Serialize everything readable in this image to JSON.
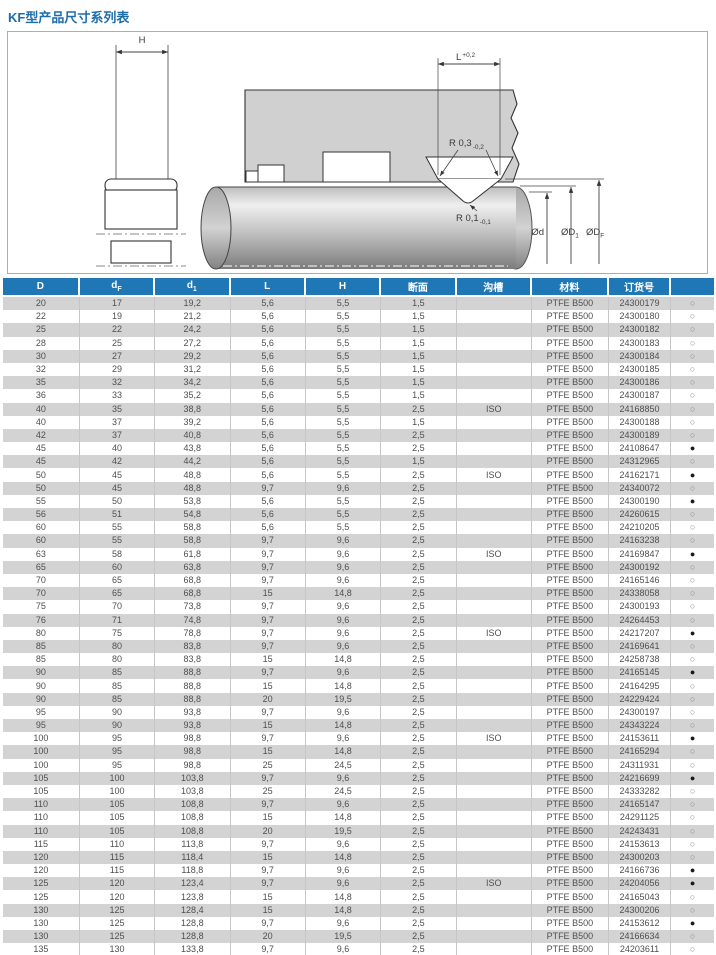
{
  "title": "KF型产品尺寸系列表",
  "diagram": {
    "labels": {
      "h": "H",
      "l": "L",
      "l_tol": "+0,2",
      "r_top": "R 0,3",
      "r_top_tol": "-0,2",
      "r_bottom": "R 0,1",
      "r_bottom_tol": "-0,1",
      "dia_d": "Ød",
      "dia_d1": "ØD",
      "dia_d1_sub": "1",
      "dia_df": "ØD",
      "dia_df_sub": "F"
    }
  },
  "table": {
    "headers": {
      "col_d": "D",
      "col_df": "d",
      "col_df_sub": "F",
      "col_d1": "d",
      "col_d1_sub": "1",
      "col_l": "L",
      "col_h": "H",
      "col_section": "断面",
      "col_groove": "沟槽",
      "col_material": "材料",
      "col_order": "订货号"
    },
    "rows": [
      [
        "20",
        "17",
        "19,2",
        "5,6",
        "5,5",
        "1,5",
        "",
        "PTFE B500",
        "24300179",
        "○"
      ],
      [
        "22",
        "19",
        "21,2",
        "5,6",
        "5,5",
        "1,5",
        "",
        "PTFE B500",
        "24300180",
        "○"
      ],
      [
        "25",
        "22",
        "24,2",
        "5,6",
        "5,5",
        "1,5",
        "",
        "PTFE B500",
        "24300182",
        "○"
      ],
      [
        "28",
        "25",
        "27,2",
        "5,6",
        "5,5",
        "1,5",
        "",
        "PTFE B500",
        "24300183",
        "○"
      ],
      [
        "30",
        "27",
        "29,2",
        "5,6",
        "5,5",
        "1,5",
        "",
        "PTFE B500",
        "24300184",
        "○"
      ],
      [
        "32",
        "29",
        "31,2",
        "5,6",
        "5,5",
        "1,5",
        "",
        "PTFE B500",
        "24300185",
        "○"
      ],
      [
        "35",
        "32",
        "34,2",
        "5,6",
        "5,5",
        "1,5",
        "",
        "PTFE B500",
        "24300186",
        "○"
      ],
      [
        "36",
        "33",
        "35,2",
        "5,6",
        "5,5",
        "1,5",
        "",
        "PTFE B500",
        "24300187",
        "○"
      ],
      [
        "40",
        "35",
        "38,8",
        "5,6",
        "5,5",
        "2,5",
        "ISO",
        "PTFE B500",
        "24168850",
        "○"
      ],
      [
        "40",
        "37",
        "39,2",
        "5,6",
        "5,5",
        "1,5",
        "",
        "PTFE B500",
        "24300188",
        "○"
      ],
      [
        "42",
        "37",
        "40,8",
        "5,6",
        "5,5",
        "2,5",
        "",
        "PTFE B500",
        "24300189",
        "○"
      ],
      [
        "45",
        "40",
        "43,8",
        "5,6",
        "5,5",
        "2,5",
        "",
        "PTFE B500",
        "24108647",
        "●"
      ],
      [
        "45",
        "42",
        "44,2",
        "5,6",
        "5,5",
        "1,5",
        "",
        "PTFE B500",
        "24312965",
        "○"
      ],
      [
        "50",
        "45",
        "48,8",
        "5,6",
        "5,5",
        "2,5",
        "ISO",
        "PTFE B500",
        "24162171",
        "●"
      ],
      [
        "50",
        "45",
        "48,8",
        "9,7",
        "9,6",
        "2,5",
        "",
        "PTFE B500",
        "24340072",
        "○"
      ],
      [
        "55",
        "50",
        "53,8",
        "5,6",
        "5,5",
        "2,5",
        "",
        "PTFE B500",
        "24300190",
        "●"
      ],
      [
        "56",
        "51",
        "54,8",
        "5,6",
        "5,5",
        "2,5",
        "",
        "PTFE B500",
        "24260615",
        "○"
      ],
      [
        "60",
        "55",
        "58,8",
        "5,6",
        "5,5",
        "2,5",
        "",
        "PTFE B500",
        "24210205",
        "○"
      ],
      [
        "60",
        "55",
        "58,8",
        "9,7",
        "9,6",
        "2,5",
        "",
        "PTFE B500",
        "24163238",
        "○"
      ],
      [
        "63",
        "58",
        "61,8",
        "9,7",
        "9,6",
        "2,5",
        "ISO",
        "PTFE B500",
        "24169847",
        "●"
      ],
      [
        "65",
        "60",
        "63,8",
        "9,7",
        "9,6",
        "2,5",
        "",
        "PTFE B500",
        "24300192",
        "○"
      ],
      [
        "70",
        "65",
        "68,8",
        "9,7",
        "9,6",
        "2,5",
        "",
        "PTFE B500",
        "24165146",
        "○"
      ],
      [
        "70",
        "65",
        "68,8",
        "15",
        "14,8",
        "2,5",
        "",
        "PTFE B500",
        "24338058",
        "○"
      ],
      [
        "75",
        "70",
        "73,8",
        "9,7",
        "9,6",
        "2,5",
        "",
        "PTFE B500",
        "24300193",
        "○"
      ],
      [
        "76",
        "71",
        "74,8",
        "9,7",
        "9,6",
        "2,5",
        "",
        "PTFE B500",
        "24264453",
        "○"
      ],
      [
        "80",
        "75",
        "78,8",
        "9,7",
        "9,6",
        "2,5",
        "ISO",
        "PTFE B500",
        "24217207",
        "●"
      ],
      [
        "85",
        "80",
        "83,8",
        "9,7",
        "9,6",
        "2,5",
        "",
        "PTFE B500",
        "24169641",
        "○"
      ],
      [
        "85",
        "80",
        "83,8",
        "15",
        "14,8",
        "2,5",
        "",
        "PTFE B500",
        "24258738",
        "○"
      ],
      [
        "90",
        "85",
        "88,8",
        "9,7",
        "9,6",
        "2,5",
        "",
        "PTFE B500",
        "24165145",
        "●"
      ],
      [
        "90",
        "85",
        "88,8",
        "15",
        "14,8",
        "2,5",
        "",
        "PTFE B500",
        "24164295",
        "○"
      ],
      [
        "90",
        "85",
        "88,8",
        "20",
        "19,5",
        "2,5",
        "",
        "PTFE B500",
        "24229424",
        "○"
      ],
      [
        "95",
        "90",
        "93,8",
        "9,7",
        "9,6",
        "2,5",
        "",
        "PTFE B500",
        "24300197",
        "○"
      ],
      [
        "95",
        "90",
        "93,8",
        "15",
        "14,8",
        "2,5",
        "",
        "PTFE B500",
        "24343224",
        "○"
      ],
      [
        "100",
        "95",
        "98,8",
        "9,7",
        "9,6",
        "2,5",
        "ISO",
        "PTFE B500",
        "24153611",
        "●"
      ],
      [
        "100",
        "95",
        "98,8",
        "15",
        "14,8",
        "2,5",
        "",
        "PTFE B500",
        "24165294",
        "○"
      ],
      [
        "100",
        "95",
        "98,8",
        "25",
        "24,5",
        "2,5",
        "",
        "PTFE B500",
        "24311931",
        "○"
      ],
      [
        "105",
        "100",
        "103,8",
        "9,7",
        "9,6",
        "2,5",
        "",
        "PTFE B500",
        "24216699",
        "●"
      ],
      [
        "105",
        "100",
        "103,8",
        "25",
        "24,5",
        "2,5",
        "",
        "PTFE B500",
        "24333282",
        "○"
      ],
      [
        "110",
        "105",
        "108,8",
        "9,7",
        "9,6",
        "2,5",
        "",
        "PTFE B500",
        "24165147",
        "○"
      ],
      [
        "110",
        "105",
        "108,8",
        "15",
        "14,8",
        "2,5",
        "",
        "PTFE B500",
        "24291125",
        "○"
      ],
      [
        "110",
        "105",
        "108,8",
        "20",
        "19,5",
        "2,5",
        "",
        "PTFE B500",
        "24243431",
        "○"
      ],
      [
        "115",
        "110",
        "113,8",
        "9,7",
        "9,6",
        "2,5",
        "",
        "PTFE B500",
        "24153613",
        "○"
      ],
      [
        "120",
        "115",
        "118,4",
        "15",
        "14,8",
        "2,5",
        "",
        "PTFE B500",
        "24300203",
        "○"
      ],
      [
        "120",
        "115",
        "118,8",
        "9,7",
        "9,6",
        "2,5",
        "",
        "PTFE B500",
        "24166736",
        "●"
      ],
      [
        "125",
        "120",
        "123,4",
        "9,7",
        "9,6",
        "2,5",
        "ISO",
        "PTFE B500",
        "24204056",
        "●"
      ],
      [
        "125",
        "120",
        "123,8",
        "15",
        "14,8",
        "2,5",
        "",
        "PTFE B500",
        "24165043",
        "○"
      ],
      [
        "130",
        "125",
        "128,4",
        "15",
        "14,8",
        "2,5",
        "",
        "PTFE B500",
        "24300206",
        "○"
      ],
      [
        "130",
        "125",
        "128,8",
        "9,7",
        "9,6",
        "2,5",
        "",
        "PTFE B500",
        "24153612",
        "●"
      ],
      [
        "130",
        "125",
        "128,8",
        "20",
        "19,5",
        "2,5",
        "",
        "PTFE B500",
        "24166634",
        "○"
      ],
      [
        "135",
        "130",
        "133,8",
        "9,7",
        "9,6",
        "2,5",
        "",
        "PTFE B500",
        "24203611",
        "○"
      ]
    ]
  }
}
